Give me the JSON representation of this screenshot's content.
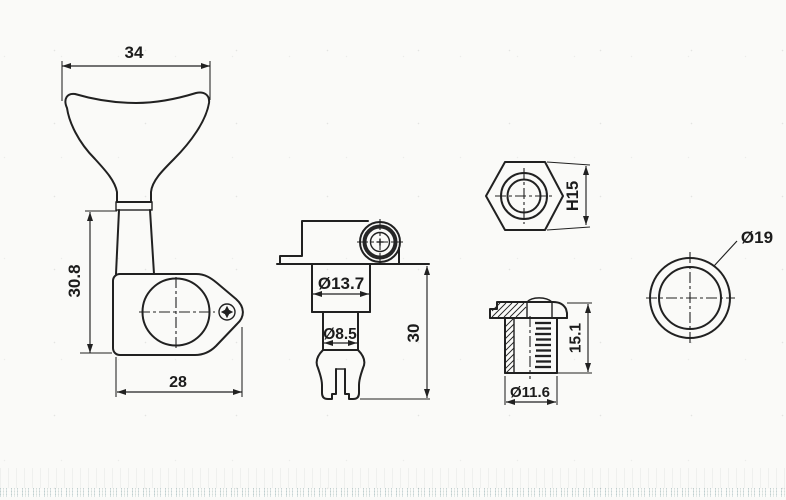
{
  "drawing": {
    "type": "technical-drawing",
    "subject": "bass tuning machine head parts with dimensions",
    "colors": {
      "line": "#212121",
      "background": "#fafaf8",
      "noise_tint": "#678d90"
    },
    "views": {
      "side": {
        "name": "tuner side view with paddle button",
        "label_top_width": "34",
        "label_height": "30.8",
        "label_bottom_width": "28"
      },
      "front": {
        "name": "tuner front view with string post",
        "label_housing_dia": "Ø13.7",
        "label_post_dia": "Ø8.5",
        "label_height": "30"
      },
      "hex_nut": {
        "name": "hex mounting nut",
        "label_height": "H15"
      },
      "bushing": {
        "name": "threaded bushing cross-section",
        "label_height": "15.1",
        "label_dia": "Ø11.6"
      },
      "washer": {
        "name": "round washer",
        "label_dia": "Ø19"
      }
    }
  }
}
